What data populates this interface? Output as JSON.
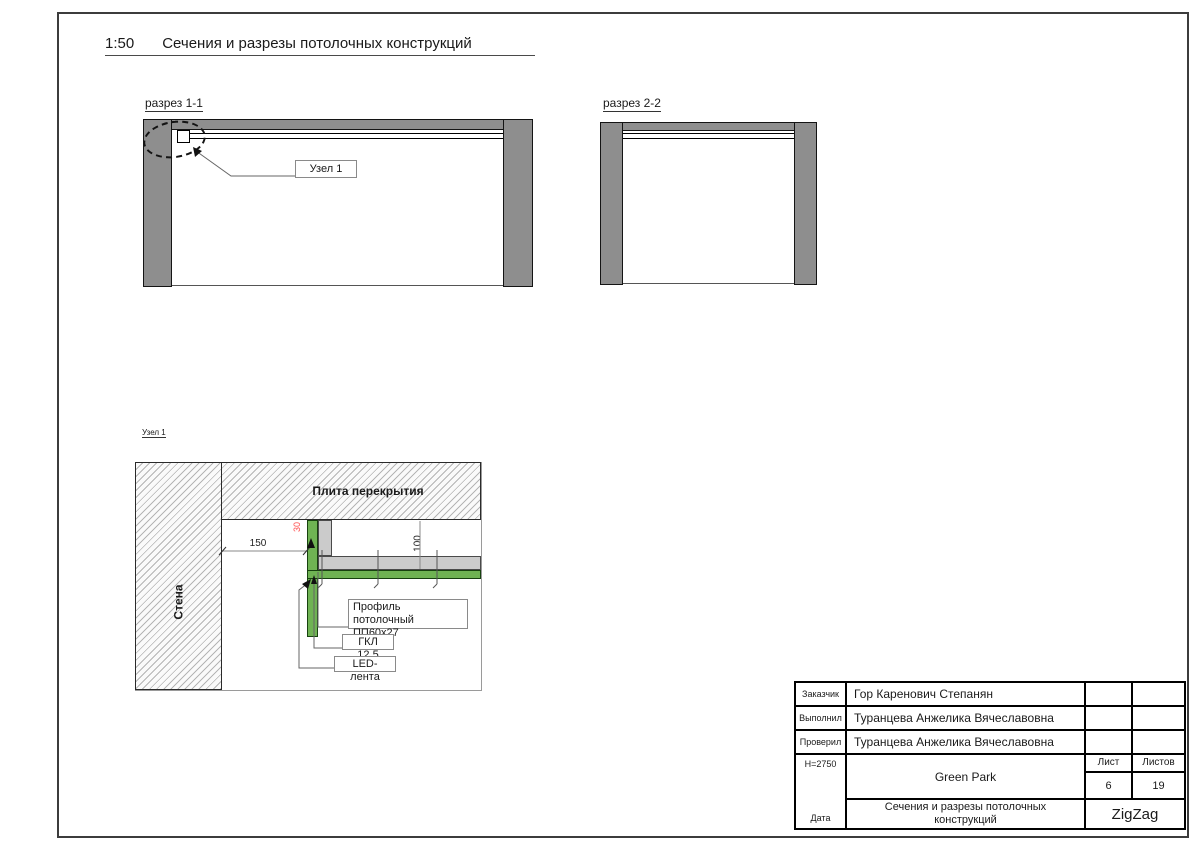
{
  "page": {
    "title_scale": "1:50",
    "title": "Сечения и разрезы потолочных конструкций"
  },
  "sections": {
    "s1": {
      "label": "разрез 1-1",
      "callout": "Узел 1"
    },
    "s2": {
      "label": "разрез 2-2"
    }
  },
  "detail": {
    "label": "Узел 1",
    "slab_label": "Плита перекрытия",
    "wall_label": "Стена",
    "dim_offset": "150",
    "dim_drop": "30",
    "dim_height": "100",
    "callout_profile_line1": "Профиль потолочный",
    "callout_profile_line2": "ПП60х27",
    "callout_gkl": "ГКЛ 12,5",
    "callout_led": "LED-лента"
  },
  "titleblock": {
    "customer_label": "Заказчик",
    "customer": "Гор Каренович Степанян",
    "author_label": "Выполнил",
    "author": "Туранцева Анжелика Вячеславовна",
    "checker_label": "Проверил",
    "checker": "Туранцева Анжелика Вячеславовна",
    "height_note": "Н=2750",
    "date_label": "Дата",
    "project": "Green Park",
    "sheet_label": "Лист",
    "sheet_number": "6",
    "sheets_label": "Листов",
    "sheets_total": "19",
    "doc_title": "Сечения и разрезы потолочных конструкций",
    "logo": "ZigZag"
  },
  "colors": {
    "wall_gray": "#8E8E8E",
    "profile_gray": "#CBCBCB",
    "gkl_green": "#6FB353",
    "dim_red": "#FF5050"
  }
}
